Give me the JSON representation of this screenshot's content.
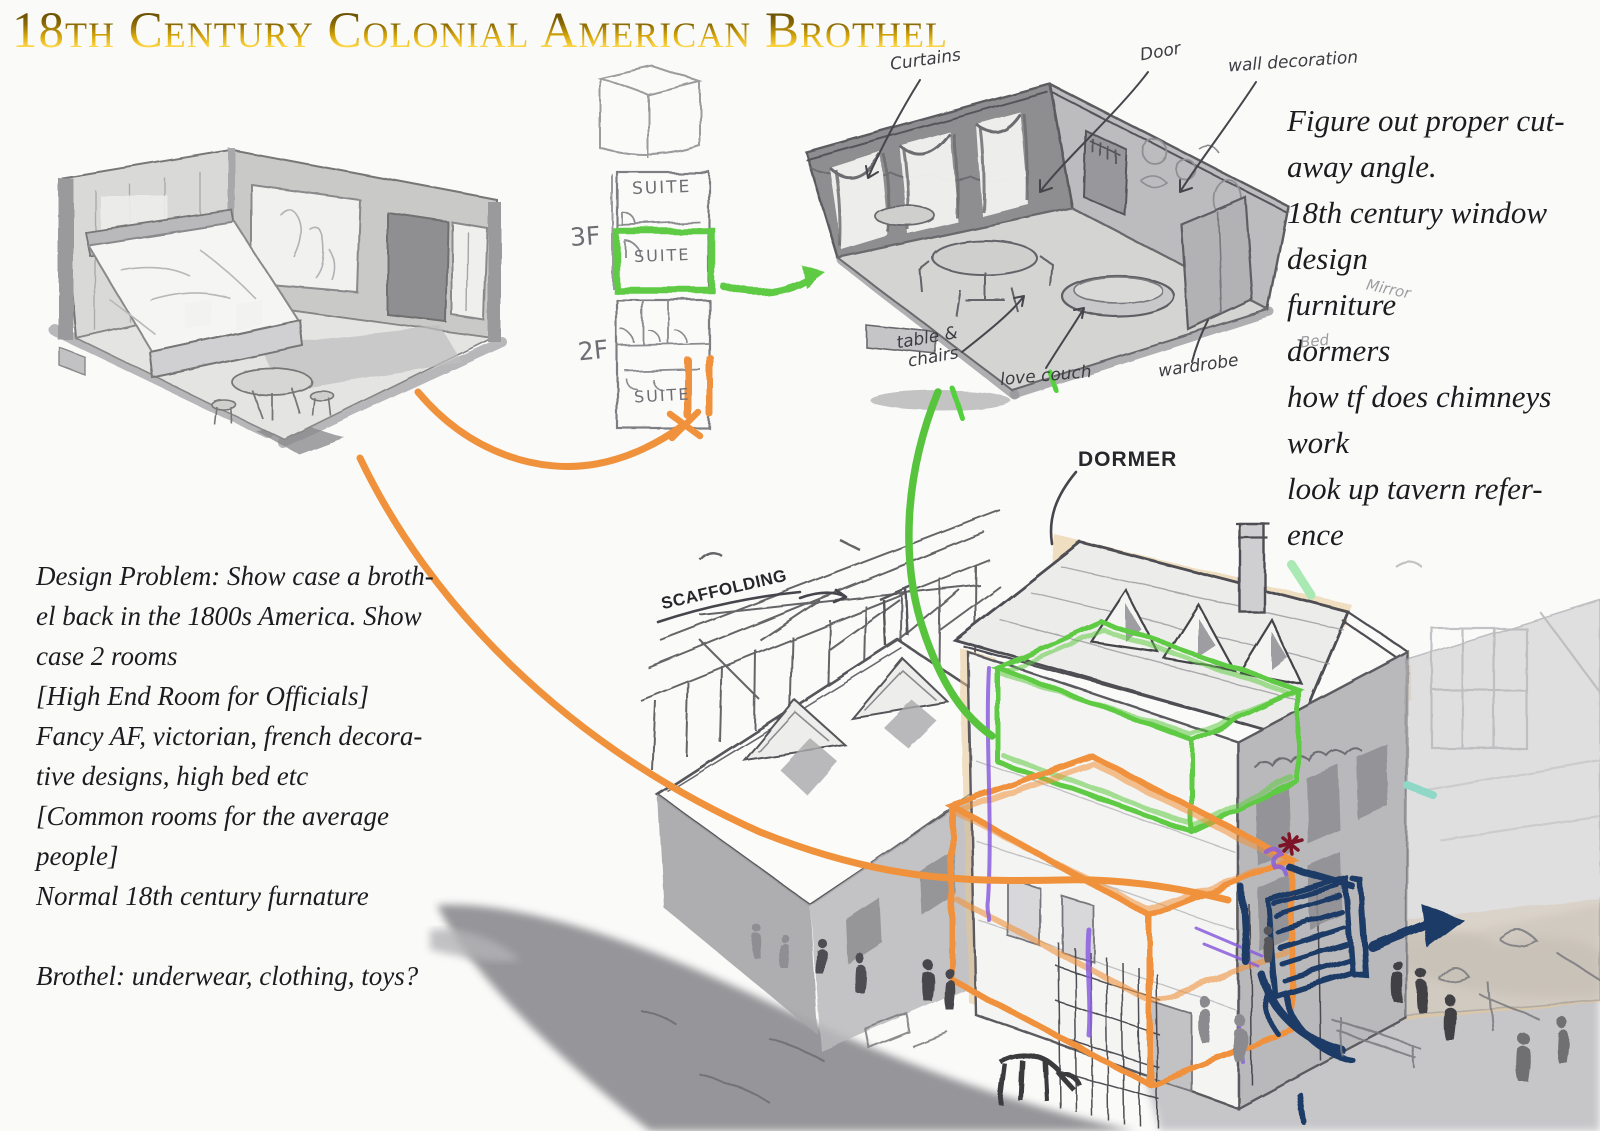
{
  "title": "18th Century Colonial American Brothel",
  "right_notes": {
    "lines": [
      "Figure out proper cut-",
      "away angle.",
      "18th century window",
      "design",
      "furniture",
      "dormers",
      "how tf does chimneys",
      "work",
      "look up tavern refer-",
      "ence"
    ]
  },
  "left_notes": {
    "lines": [
      "Design Problem: Show case a broth-",
      "el back in the 1800s America. Show",
      "case 2 rooms",
      "[High End Room for Officials]",
      "Fancy AF, victorian, french decora-",
      "tive designs, high bed etc",
      "[Common rooms for the average",
      "people]",
      "Normal 18th century furnature",
      "",
      "Brothel: underwear, clothing, toys?"
    ]
  },
  "floor_plans": {
    "third_floor_label": "3F",
    "second_floor_label": "2F",
    "suite_upper": "SUITE",
    "suite_highlight": "SUITE",
    "suite_second": "SUITE"
  },
  "annotations": {
    "curtains": "Curtains",
    "door": "Door",
    "wall_decoration": "wall decoration",
    "table_chairs_line1": "table &",
    "table_chairs_line2": "chairs",
    "love_couch": "love couch",
    "wardrobe": "wardrobe",
    "mirror": "Mirror",
    "bed": "Bed",
    "dormer": "DORMER",
    "scaffolding": "SCAFFOLDING"
  },
  "colors": {
    "title_gold": "#b8860b",
    "highlight_green": "#5ecb44",
    "highlight_orange": "#f0923c",
    "annotation_navy": "#1d3a66",
    "accent_purple": "#8a5ede",
    "accent_red": "#7c1326",
    "sketch_gray": "#8f8f92",
    "wash_tan": "#e7c694"
  }
}
